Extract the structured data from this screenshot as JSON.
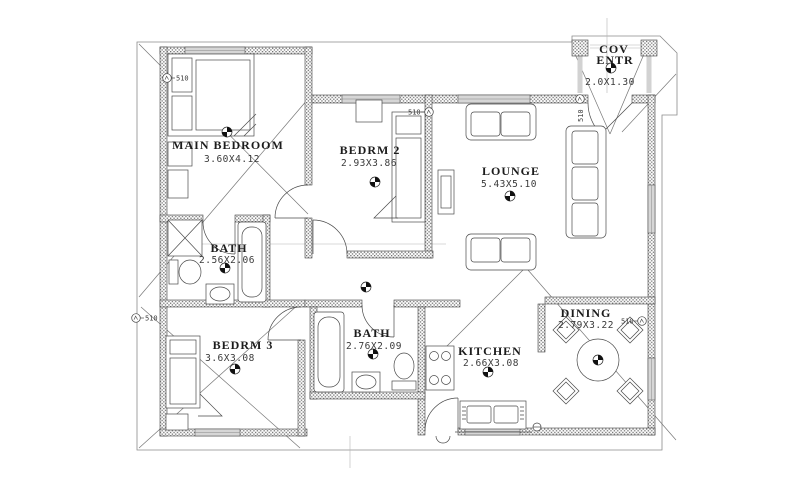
{
  "drawing": {
    "type": "architectural floor plan",
    "rooms": {
      "main_bedroom": {
        "name": "MAIN BEDROOM",
        "dims": "3.60X4.12"
      },
      "bedrm2": {
        "name": "BEDRM 2",
        "dims": "2.93X3.86"
      },
      "lounge": {
        "name": "LOUNGE",
        "dims": "5.43X5.10"
      },
      "bath1": {
        "name": "BATH",
        "dims": "2.56X2.06"
      },
      "bedrm3": {
        "name": "BEDRM 3",
        "dims": "3.6X3.08"
      },
      "bath2": {
        "name": "BATH",
        "dims": "2.76X2.09"
      },
      "kitchen": {
        "name": "KITCHEN",
        "dims": "2.66X3.08"
      },
      "dining": {
        "name": "DINING",
        "dims": "2.79X3.22"
      },
      "cov_entr": {
        "line1": "COV",
        "line2": "ENTR",
        "dims": "2.0X1.30"
      }
    },
    "markers": {
      "label": "510"
    },
    "colors": {
      "background": "#ffffff",
      "wall_stipple": "#6e6e6e",
      "line": "#4a4a4a",
      "roof_line": "#8a8a8a",
      "window_fill": "#d6d6d6"
    }
  }
}
